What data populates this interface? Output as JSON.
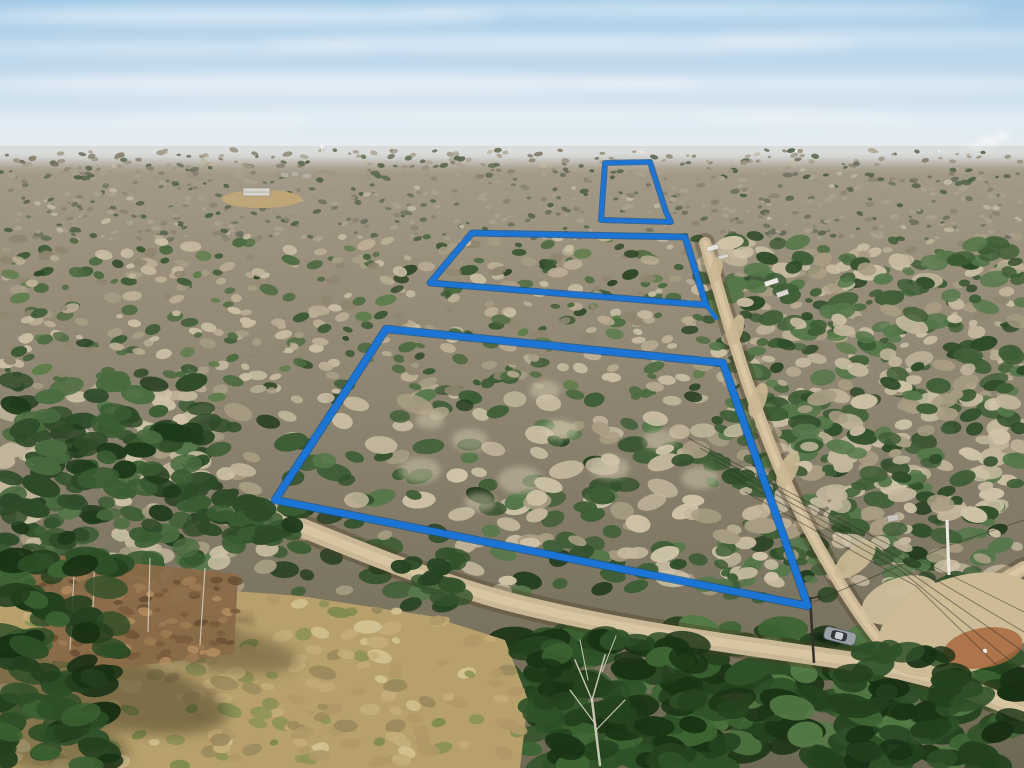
{
  "meta": {
    "title": "Aerial drone photo of wooded acreage with three lot boundaries outlined in blue",
    "width": 1024,
    "height": 768
  },
  "sky": {
    "stops": [
      [
        "0%",
        "#a4cae7"
      ],
      [
        "45%",
        "#c2d9ec"
      ],
      [
        "80%",
        "#dde9f1"
      ],
      [
        "100%",
        "#e9eff3"
      ]
    ],
    "haze": {
      "x": -20,
      "y": 138,
      "w": 1064,
      "h": 24,
      "fill": "#e6ebee",
      "opacity": 0.85
    },
    "clouds": [
      {
        "x": 240,
        "y": 16,
        "rx": 260,
        "ry": 9,
        "o": 0.5
      },
      {
        "x": 690,
        "y": 10,
        "rx": 300,
        "ry": 8,
        "o": 0.4
      },
      {
        "x": 170,
        "y": 48,
        "rx": 210,
        "ry": 8,
        "o": 0.35
      },
      {
        "x": 560,
        "y": 44,
        "rx": 300,
        "ry": 10,
        "o": 0.45
      },
      {
        "x": 890,
        "y": 38,
        "rx": 190,
        "ry": 8,
        "o": 0.35
      },
      {
        "x": 340,
        "y": 84,
        "rx": 360,
        "ry": 11,
        "o": 0.5
      },
      {
        "x": 820,
        "y": 84,
        "rx": 240,
        "ry": 9,
        "o": 0.4
      },
      {
        "x": 520,
        "y": 116,
        "rx": 400,
        "ry": 9,
        "o": 0.35
      },
      {
        "x": 130,
        "y": 124,
        "rx": 180,
        "ry": 7,
        "o": 0.3
      },
      {
        "x": 900,
        "y": 120,
        "rx": 200,
        "ry": 7,
        "o": 0.3
      }
    ]
  },
  "ground": {
    "stops": [
      [
        "0%",
        "#a59c8b"
      ],
      [
        "20%",
        "#988e7b"
      ],
      [
        "45%",
        "#8b8270"
      ],
      [
        "70%",
        "#7d7662"
      ],
      [
        "100%",
        "#6e6955"
      ]
    ],
    "y": 146
  },
  "horizon_objects": {
    "water_tower": {
      "x": 322,
      "y": 146
    },
    "specks": [
      [
        640,
        151
      ],
      [
        795,
        150
      ],
      [
        938,
        150
      ]
    ],
    "smoke": [
      {
        "x": 988,
        "y": 141,
        "rx": 9,
        "ry": 4,
        "o": 0.65
      },
      {
        "x": 1002,
        "y": 136,
        "rx": 7,
        "ry": 3.5,
        "o": 0.6
      },
      {
        "x": 975,
        "y": 146,
        "rx": 6,
        "ry": 3,
        "o": 0.55
      }
    ],
    "buildings": [
      [
        281,
        173,
        7,
        4
      ],
      [
        292,
        172,
        6,
        4
      ],
      [
        303,
        174,
        8,
        4
      ]
    ]
  },
  "texture_bands": [
    {
      "name": "far",
      "x": [
        0,
        1024
      ],
      "y": [
        150,
        240
      ],
      "count": 900,
      "r": [
        1.5,
        3.5
      ],
      "palette": [
        [
          "#9d9584",
          4
        ],
        [
          "#aaa190",
          4
        ],
        [
          "#8a8371",
          3
        ],
        [
          "#6e7260",
          2
        ],
        [
          "#5c6850",
          2
        ],
        [
          "#4f6244",
          1
        ],
        [
          "#c0b7a1",
          1
        ]
      ]
    },
    {
      "name": "mid",
      "x": [
        0,
        1024
      ],
      "y": [
        236,
        400
      ],
      "count": 700,
      "r": [
        3,
        7
      ],
      "palette": [
        [
          "#bbae95",
          3
        ],
        [
          "#c9bda4",
          3
        ],
        [
          "#a79c84",
          2
        ],
        [
          "#8f8570",
          2
        ],
        [
          "#4e6b42",
          2
        ],
        [
          "#3d5a36",
          2
        ],
        [
          "#5e7d4b",
          1
        ],
        [
          "#2f4829",
          1
        ]
      ]
    },
    {
      "name": "near",
      "x": [
        0,
        1024
      ],
      "y": [
        394,
        592
      ],
      "count": 460,
      "r": [
        6,
        12
      ],
      "palette": [
        [
          "#c3b79d",
          3
        ],
        [
          "#d0c4a9",
          2
        ],
        [
          "#a89d83",
          2
        ],
        [
          "#3f5e37",
          3
        ],
        [
          "#32502c",
          2
        ],
        [
          "#55774a",
          2
        ],
        [
          "#243d20",
          1
        ]
      ]
    },
    {
      "name": "left-pines",
      "x": [
        0,
        205
      ],
      "y": [
        378,
        600
      ],
      "count": 120,
      "r": [
        8,
        14
      ],
      "palette": [
        [
          "#2e4a29",
          3
        ],
        [
          "#3a5c33",
          3
        ],
        [
          "#1f3a1c",
          2
        ],
        [
          "#4a6b3f",
          2
        ]
      ]
    },
    {
      "name": "right-strip",
      "x": [
        700,
        1024
      ],
      "y": [
        240,
        600
      ],
      "count": 380,
      "r": [
        5,
        11
      ],
      "palette": [
        [
          "#3f5e37",
          3
        ],
        [
          "#2f4c2a",
          2
        ],
        [
          "#55774a",
          2
        ],
        [
          "#c3b79d",
          2
        ],
        [
          "#cfc3a8",
          1
        ],
        [
          "#a89d83",
          1
        ]
      ]
    },
    {
      "name": "bottom-forest-right",
      "x": [
        500,
        1024
      ],
      "y": [
        628,
        768
      ],
      "count": 250,
      "r": [
        10,
        18
      ],
      "palette": [
        [
          "#25421f",
          3
        ],
        [
          "#2f5128",
          3
        ],
        [
          "#1a3315",
          2
        ],
        [
          "#3d6432",
          2
        ],
        [
          "#547a45",
          1
        ]
      ]
    }
  ],
  "highlight_blobs": [
    [
      420,
      470,
      16
    ],
    [
      470,
      440,
      14
    ],
    [
      520,
      480,
      17
    ],
    [
      560,
      430,
      13
    ],
    [
      610,
      468,
      15
    ],
    [
      660,
      440,
      13
    ],
    [
      700,
      478,
      14
    ],
    [
      480,
      502,
      12
    ],
    [
      545,
      390,
      12
    ],
    [
      430,
      420,
      11
    ]
  ],
  "field": {
    "polygon": [
      [
        0,
        598
      ],
      [
        140,
        584
      ],
      [
        300,
        596
      ],
      [
        430,
        616
      ],
      [
        505,
        640
      ],
      [
        528,
        700
      ],
      [
        520,
        768
      ],
      [
        0,
        768
      ]
    ],
    "base": "#b7a06c",
    "texture": {
      "count": 260,
      "r": [
        4,
        9
      ],
      "palette": [
        [
          "#c4ad79",
          3
        ],
        [
          "#b09868",
          3
        ],
        [
          "#9b8a5d",
          2
        ],
        [
          "#8d9257",
          2
        ],
        [
          "#d3c392",
          2
        ],
        [
          "#7d8a4e",
          1
        ]
      ]
    },
    "shadows": [
      {
        "cx": 95,
        "cy": 688,
        "rx": 135,
        "ry": 38,
        "rot": 12,
        "o": 0.42
      },
      {
        "cx": 205,
        "cy": 648,
        "rx": 95,
        "ry": 22,
        "rot": 8,
        "o": 0.32
      },
      {
        "cx": 40,
        "cy": 740,
        "rx": 90,
        "ry": 30,
        "rot": 10,
        "o": 0.35
      }
    ],
    "streaks": [
      [
        40,
        592,
        255,
        622,
        7,
        0.28
      ],
      [
        60,
        604,
        240,
        632,
        5,
        0.22
      ],
      [
        30,
        616,
        200,
        640,
        5,
        0.18
      ]
    ]
  },
  "floor_patch": {
    "polygon": [
      [
        28,
        552
      ],
      [
        238,
        574
      ],
      [
        234,
        654
      ],
      [
        120,
        668
      ],
      [
        48,
        660
      ]
    ],
    "base": "#8a6a48",
    "texture": {
      "count": 90,
      "r": [
        3,
        6
      ],
      "palette": [
        [
          "#9c7a52",
          3
        ],
        [
          "#7a5c3c",
          3
        ],
        [
          "#b08a5e",
          2
        ],
        [
          "#6b5034",
          2
        ]
      ]
    },
    "trunks": [
      [
        75,
        556,
        70,
        650
      ],
      [
        95,
        552,
        92,
        640
      ],
      [
        150,
        558,
        148,
        632
      ],
      [
        205,
        568,
        200,
        645
      ]
    ]
  },
  "roads": {
    "surface": "#c9b795",
    "center": "#dbc9a5",
    "shoulder": "rgba(74,60,38,0.35)",
    "main": {
      "d": "M 282,520 C 340,542 420,578 510,602 C 620,630 720,642 830,658 C 920,670 975,690 1024,712",
      "width": 19
    },
    "side": {
      "d": "M 705,243 C 726,316 756,424 798,508 C 824,560 860,620 886,648",
      "width": 12
    },
    "spur": {
      "d": "M 880,652 C 925,625 975,596 1024,568",
      "width": 14
    }
  },
  "clearings": [
    {
      "cx": 262,
      "cy": 199,
      "rx": 40,
      "ry": 9,
      "rot": 0,
      "fill": "#c0a678",
      "o": 0.95
    },
    {
      "cx": 716,
      "cy": 270,
      "rx": 14,
      "ry": 6,
      "rot": -75,
      "fill": "#c9b790",
      "o": 0.9
    },
    {
      "cx": 736,
      "cy": 330,
      "rx": 16,
      "ry": 7,
      "rot": -72,
      "fill": "#c9b790",
      "o": 0.9
    },
    {
      "cx": 758,
      "cy": 400,
      "rx": 18,
      "ry": 8,
      "rot": -70,
      "fill": "#c9b790",
      "o": 0.9
    },
    {
      "cx": 788,
      "cy": 470,
      "rx": 20,
      "ry": 9,
      "rot": -65,
      "fill": "#c9b790",
      "o": 0.9
    },
    {
      "cx": 855,
      "cy": 560,
      "rx": 25,
      "ry": 12,
      "rot": -40,
      "fill": "#cdbb96",
      "o": 0.9
    },
    {
      "cx": 900,
      "cy": 600,
      "rx": 40,
      "ry": 22,
      "rot": -20,
      "fill": "#d2c19d",
      "o": 0.9
    },
    {
      "cx": 960,
      "cy": 625,
      "rx": 85,
      "ry": 48,
      "rot": -18,
      "fill": "#cdbb96",
      "o": 1
    },
    {
      "cx": 983,
      "cy": 648,
      "rx": 40,
      "ry": 20,
      "rot": -10,
      "fill": "#a8693f",
      "o": 0.85
    }
  ],
  "white_speck": {
    "cx": 985,
    "cy": 651,
    "r": 2.2,
    "fill": "#f5f2ea"
  },
  "pine_clusters_extra": [
    {
      "name": "cover-road-left",
      "x": [
        205,
        300
      ],
      "y": [
        495,
        548
      ],
      "count": 26,
      "r": [
        8,
        13
      ],
      "palette": [
        [
          "#2e4a29",
          3
        ],
        [
          "#3a5c33",
          2
        ],
        [
          "#223c1e",
          2
        ]
      ]
    },
    {
      "name": "cover-road-mid",
      "x": [
        400,
        470
      ],
      "y": [
        552,
        606
      ],
      "count": 18,
      "r": [
        7,
        12
      ],
      "palette": [
        [
          "#33522c",
          3
        ],
        [
          "#264323",
          2
        ]
      ]
    },
    {
      "name": "corner-pines",
      "x": [
        845,
        1024
      ],
      "y": [
        648,
        768
      ],
      "count": 46,
      "r": [
        10,
        16
      ],
      "palette": [
        [
          "#24401f",
          3
        ],
        [
          "#2e4f28",
          3
        ],
        [
          "#183014",
          2
        ]
      ]
    },
    {
      "name": "center-pines",
      "x": [
        530,
        700
      ],
      "y": [
        638,
        768
      ],
      "count": 55,
      "r": [
        10,
        16
      ],
      "palette": [
        [
          "#25421f",
          3
        ],
        [
          "#2f5128",
          2
        ],
        [
          "#1a3315",
          2
        ],
        [
          "#3d6432",
          1
        ]
      ]
    },
    {
      "name": "bottom-left-pines",
      "x": [
        0,
        118
      ],
      "y": [
        552,
        768
      ],
      "count": 80,
      "r": [
        10,
        17
      ],
      "palette": [
        [
          "#24401f",
          3
        ],
        [
          "#2e4f28",
          3
        ],
        [
          "#183014",
          2
        ],
        [
          "#3b6131",
          2
        ]
      ]
    }
  ],
  "structures": {
    "barn": {
      "x": 243,
      "y": 188,
      "w": 27,
      "h": 8,
      "fill": "#d7d4cc",
      "stroke": "#8d8a82"
    },
    "trailers": [
      {
        "x": 706,
        "y": 247,
        "w": 12,
        "h": 5,
        "rot": -15,
        "fill": "#e6e3dc"
      },
      {
        "x": 718,
        "y": 256,
        "w": 10,
        "h": 4,
        "rot": -15,
        "fill": "#d8d5ce"
      },
      {
        "x": 764,
        "y": 282,
        "w": 14,
        "h": 5,
        "rot": -18,
        "fill": "#eeebe4"
      },
      {
        "x": 776,
        "y": 293,
        "w": 12,
        "h": 5,
        "rot": -18,
        "fill": "#dcd8d0"
      },
      {
        "x": 887,
        "y": 516,
        "w": 11,
        "h": 6,
        "rot": -10,
        "fill": "#c9c6bd"
      }
    ],
    "white_pole": {
      "x1": 947,
      "y1": 520,
      "x2": 949,
      "y2": 575,
      "stroke": "#eceae2",
      "w": 3
    },
    "dark_pole": {
      "x1": 810,
      "y1": 597,
      "x2": 814,
      "y2": 663,
      "stroke": "#35302a",
      "w": 2.5,
      "crossarm": [
        801,
        601,
        821,
        596
      ]
    }
  },
  "wires": {
    "stroke": "rgba(50,46,40,0.5)",
    "lines": [
      [
        [
          688,
          438
        ],
        [
          860,
          530
        ],
        [
          1024,
          612
        ]
      ],
      [
        [
          700,
          448
        ],
        [
          872,
          542
        ],
        [
          1024,
          632
        ]
      ],
      [
        [
          714,
          460
        ],
        [
          886,
          556
        ],
        [
          1024,
          652
        ]
      ],
      [
        [
          728,
          474
        ],
        [
          900,
          570
        ],
        [
          1024,
          672
        ]
      ],
      [
        [
          745,
          492
        ],
        [
          916,
          586
        ],
        [
          1024,
          692
        ]
      ],
      [
        [
          813,
          602
        ],
        [
          947,
          546
        ],
        [
          1024,
          520
        ]
      ]
    ]
  },
  "vehicle": {
    "cx": 840,
    "cy": 636,
    "angle": 14,
    "len": 32,
    "wid": 13,
    "body": "#9aa0a6",
    "roof": "#c9ced3",
    "glass": "#33373c"
  },
  "bare_tree": {
    "color": "#d8d2c2",
    "strokes": [
      [
        600,
        765,
        592,
        700,
        2.5
      ],
      [
        592,
        700,
        575,
        660,
        1.5
      ],
      [
        592,
        700,
        605,
        655,
        1.5
      ],
      [
        596,
        725,
        570,
        690,
        1.2
      ],
      [
        596,
        730,
        625,
        700,
        1.2
      ],
      [
        588,
        680,
        580,
        640,
        1.0
      ],
      [
        602,
        672,
        616,
        636,
        1.0
      ]
    ]
  },
  "boundary": {
    "color": "#1c75d4",
    "edge": "#11518f",
    "lots": [
      {
        "name": "back lot",
        "width": 4,
        "points": [
          [
            605,
            163
          ],
          [
            650,
            162
          ],
          [
            666,
            212
          ],
          [
            671,
            222
          ],
          [
            601,
            220
          ]
        ]
      },
      {
        "name": "middle lot",
        "width": 5,
        "points": [
          [
            472,
            233
          ],
          [
            685,
            237
          ],
          [
            706,
            305
          ],
          [
            430,
            283
          ]
        ],
        "tail": [
          [
            706,
            305
          ],
          [
            716,
            318
          ]
        ]
      },
      {
        "name": "front lot",
        "width": 6.5,
        "points": [
          [
            386,
            329
          ],
          [
            723,
            363
          ],
          [
            808,
            606
          ],
          [
            275,
            500
          ]
        ]
      }
    ]
  }
}
